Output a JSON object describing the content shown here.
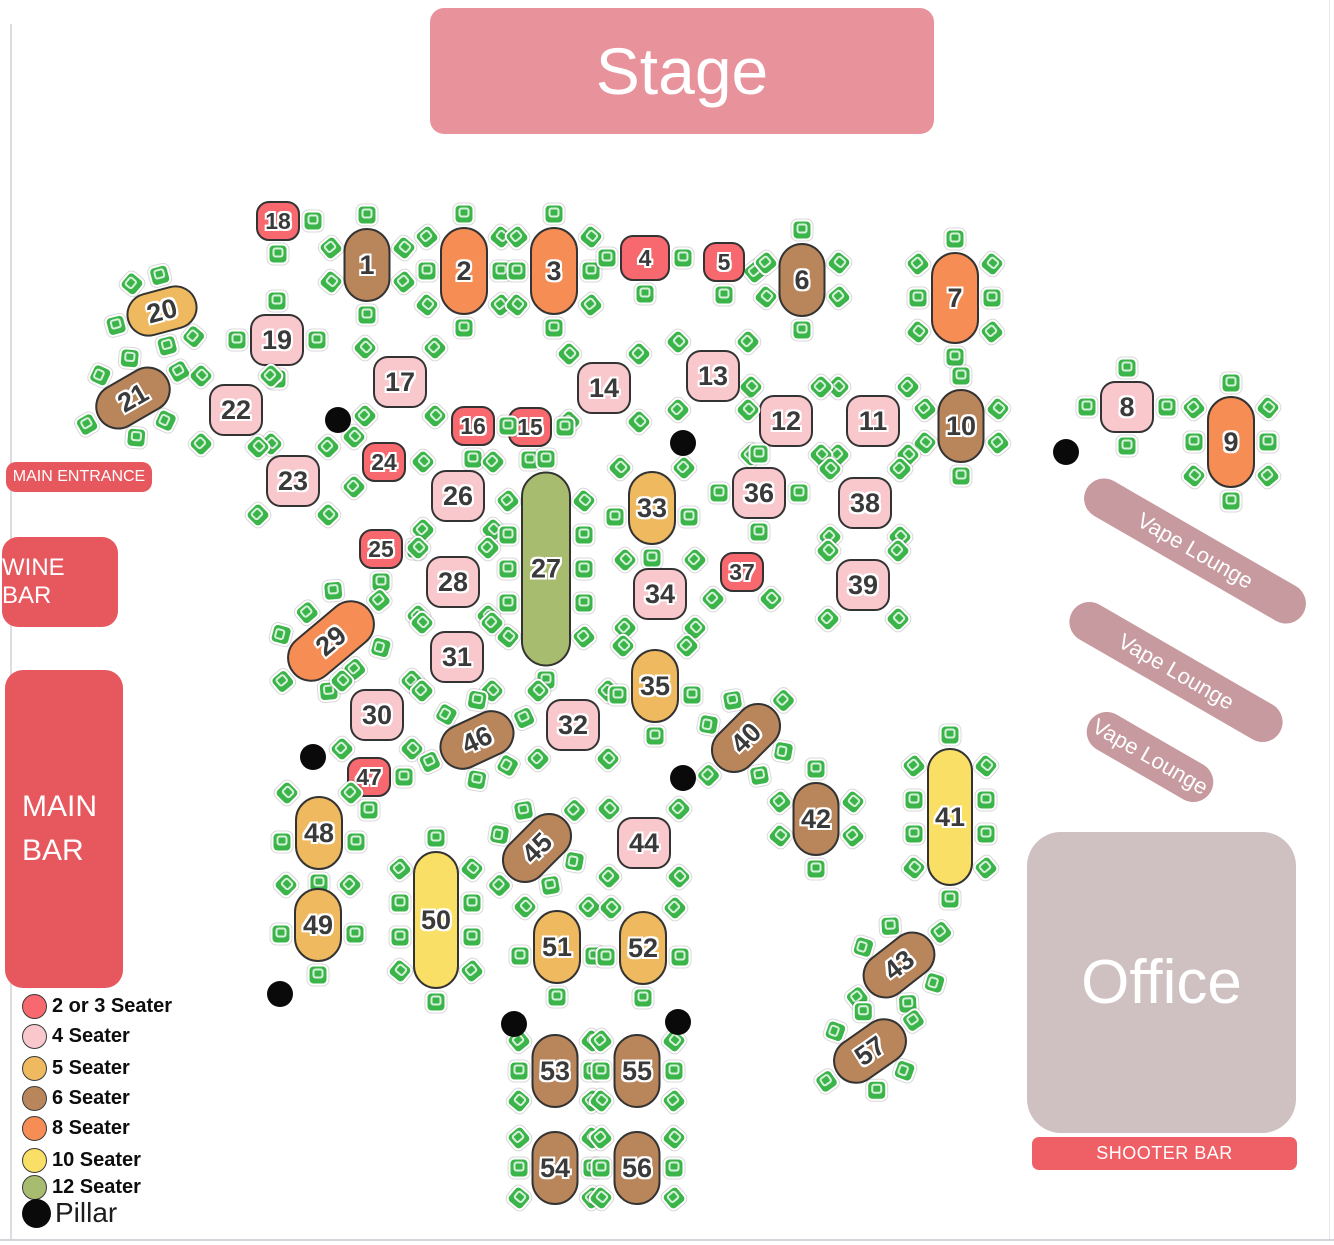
{
  "areas": {
    "stage": {
      "label": "Stage"
    },
    "main_entrance": {
      "label": "MAIN ENTRANCE"
    },
    "wine_bar": {
      "label": "WINE BAR"
    },
    "main_bar": {
      "line1": "MAIN",
      "line2": "BAR"
    },
    "office": {
      "label": "Office"
    },
    "shooter_bar": {
      "label": "SHOOTER BAR"
    },
    "vape_lounges": [
      {
        "label": "Vape Lounge",
        "cx": 1195,
        "cy": 551,
        "len": 250,
        "rot": 30
      },
      {
        "label": "Vape Lounge",
        "cx": 1176,
        "cy": 672,
        "len": 240,
        "rot": 30
      },
      {
        "label": "Vape Lounge",
        "cx": 1150,
        "cy": 757,
        "len": 140,
        "rot": 30
      }
    ]
  },
  "colors": {
    "stage": "#e8939c",
    "bar_red": "#e7575e",
    "shooter_red": "#ef6066",
    "vape_banner": "#c69a9e",
    "office": "#cfc0c2",
    "chair_green": "#3bb54a",
    "pillar_black": "#0a0a0a"
  },
  "table_colors": {
    "s2": "#f7696e",
    "s4": "#f9c8cd",
    "s5": "#eeb95f",
    "s6": "#b9855a",
    "s8": "#f68d54",
    "s10": "#f9df66",
    "s12": "#a8bc70"
  },
  "legend": {
    "items": [
      {
        "label": "2 or 3 Seater",
        "color": "#f7696e"
      },
      {
        "label": "4 Seater",
        "color": "#f9c8cd"
      },
      {
        "label": "5 Seater",
        "color": "#eeb95f"
      },
      {
        "label": "6 Seater",
        "color": "#b9855a"
      },
      {
        "label": "8 Seater",
        "color": "#f68d54"
      },
      {
        "label": "10 Seater",
        "color": "#f9df66"
      },
      {
        "label": "12 Seater",
        "color": "#a8bc70"
      }
    ],
    "pillar": {
      "label": "Pillar",
      "color": "#0a0a0a"
    }
  },
  "pillars": [
    [
      338,
      420
    ],
    [
      683,
      443
    ],
    [
      1066,
      452
    ],
    [
      313,
      757
    ],
    [
      683,
      778
    ],
    [
      280,
      994
    ],
    [
      514,
      1024
    ],
    [
      678,
      1022
    ]
  ],
  "tables": [
    {
      "n": "1",
      "x": 367,
      "y": 265,
      "kind": "s6",
      "pattern": "6v"
    },
    {
      "n": "2",
      "x": 464,
      "y": 271,
      "kind": "s8",
      "pattern": "8v"
    },
    {
      "n": "3",
      "x": 554,
      "y": 271,
      "kind": "s8",
      "pattern": "8v"
    },
    {
      "n": "4",
      "x": 645,
      "y": 258,
      "kind": "s2",
      "pattern": "3WES",
      "w": 50,
      "h": 46
    },
    {
      "n": "5",
      "x": 724,
      "y": 262,
      "kind": "s2",
      "pattern": "2SE_S",
      "w": 42,
      "h": 40
    },
    {
      "n": "6",
      "x": 802,
      "y": 280,
      "kind": "s6",
      "pattern": "6v"
    },
    {
      "n": "7",
      "x": 955,
      "y": 298,
      "kind": "s8",
      "pattern": "8v",
      "h": 92
    },
    {
      "n": "8",
      "x": 1127,
      "y": 407,
      "kind": "s4",
      "pattern": "4cross"
    },
    {
      "n": "9",
      "x": 1231,
      "y": 442,
      "kind": "s8",
      "pattern": "8v",
      "h": 92
    },
    {
      "n": "10",
      "x": 961,
      "y": 426,
      "kind": "s6",
      "pattern": "6v"
    },
    {
      "n": "11",
      "x": 873,
      "y": 421,
      "kind": "s4",
      "pattern": "4diag"
    },
    {
      "n": "12",
      "x": 786,
      "y": 421,
      "kind": "s4",
      "pattern": "4diag"
    },
    {
      "n": "13",
      "x": 713,
      "y": 376,
      "kind": "s4",
      "pattern": "4diag"
    },
    {
      "n": "14",
      "x": 604,
      "y": 388,
      "kind": "s4",
      "pattern": "4diag"
    },
    {
      "n": "15",
      "x": 530,
      "y": 427,
      "kind": "s2",
      "pattern": "2ES"
    },
    {
      "n": "16",
      "x": 473,
      "y": 426,
      "kind": "s2",
      "pattern": "2ES"
    },
    {
      "n": "17",
      "x": 400,
      "y": 382,
      "kind": "s4",
      "pattern": "4diag"
    },
    {
      "n": "18",
      "x": 278,
      "y": 221,
      "kind": "s2",
      "pattern": "2ES"
    },
    {
      "n": "19",
      "x": 277,
      "y": 340,
      "kind": "s4",
      "pattern": "4cross"
    },
    {
      "n": "20",
      "x": 162,
      "y": 311,
      "kind": "s5",
      "pattern": "5h",
      "w": 72,
      "h": 44,
      "rot": -15
    },
    {
      "n": "21",
      "x": 133,
      "y": 398,
      "kind": "s6",
      "pattern": "6h",
      "w": 80,
      "h": 46,
      "rot": -30
    },
    {
      "n": "22",
      "x": 236,
      "y": 410,
      "kind": "s4",
      "pattern": "4diag"
    },
    {
      "n": "23",
      "x": 293,
      "y": 481,
      "kind": "s4",
      "pattern": "4diag"
    },
    {
      "n": "24",
      "x": 384,
      "y": 462,
      "kind": "s2",
      "pattern": "2NW_SW"
    },
    {
      "n": "25",
      "x": 381,
      "y": 549,
      "kind": "s2",
      "pattern": "2ES"
    },
    {
      "n": "26",
      "x": 458,
      "y": 496,
      "kind": "s4",
      "pattern": "4diag"
    },
    {
      "n": "27",
      "x": 546,
      "y": 569,
      "kind": "s12",
      "pattern": "12v"
    },
    {
      "n": "28",
      "x": 453,
      "y": 582,
      "kind": "s4",
      "pattern": "4diag"
    },
    {
      "n": "29",
      "x": 331,
      "y": 641,
      "kind": "s8",
      "pattern": "8h",
      "w": 100,
      "h": 48,
      "rot": -40
    },
    {
      "n": "30",
      "x": 377,
      "y": 715,
      "kind": "s4",
      "pattern": "4diag"
    },
    {
      "n": "31",
      "x": 457,
      "y": 657,
      "kind": "s4",
      "pattern": "4diag"
    },
    {
      "n": "32",
      "x": 573,
      "y": 725,
      "kind": "s4",
      "pattern": "4diag"
    },
    {
      "n": "33",
      "x": 652,
      "y": 508,
      "kind": "s5",
      "pattern": "5"
    },
    {
      "n": "34",
      "x": 660,
      "y": 594,
      "kind": "s4",
      "pattern": "4diag"
    },
    {
      "n": "35",
      "x": 655,
      "y": 686,
      "kind": "s5",
      "pattern": "5"
    },
    {
      "n": "36",
      "x": 759,
      "y": 493,
      "kind": "s4",
      "pattern": "4cross"
    },
    {
      "n": "37",
      "x": 742,
      "y": 572,
      "kind": "s2",
      "pattern": "2SW_SE"
    },
    {
      "n": "38",
      "x": 865,
      "y": 503,
      "kind": "s4",
      "pattern": "4diag"
    },
    {
      "n": "39",
      "x": 863,
      "y": 585,
      "kind": "s4",
      "pattern": "4diag"
    },
    {
      "n": "40",
      "x": 746,
      "y": 738,
      "kind": "s6",
      "pattern": "6h",
      "w": 80,
      "h": 46,
      "rot": -45
    },
    {
      "n": "41",
      "x": 950,
      "y": 817,
      "kind": "s10",
      "pattern": "10v"
    },
    {
      "n": "42",
      "x": 816,
      "y": 819,
      "kind": "s6",
      "pattern": "6v"
    },
    {
      "n": "43",
      "x": 899,
      "y": 965,
      "kind": "s6",
      "pattern": "6h",
      "w": 80,
      "h": 46,
      "rot": -38
    },
    {
      "n": "44",
      "x": 644,
      "y": 843,
      "kind": "s4",
      "pattern": "4diag"
    },
    {
      "n": "45",
      "x": 537,
      "y": 848,
      "kind": "s6",
      "pattern": "6h",
      "w": 80,
      "h": 46,
      "rot": -45
    },
    {
      "n": "46",
      "x": 477,
      "y": 740,
      "kind": "s6",
      "pattern": "6h",
      "w": 78,
      "h": 46,
      "rot": -25
    },
    {
      "n": "47",
      "x": 369,
      "y": 777,
      "kind": "s2",
      "pattern": "2ES"
    },
    {
      "n": "48",
      "x": 319,
      "y": 833,
      "kind": "s5",
      "pattern": "5"
    },
    {
      "n": "49",
      "x": 318,
      "y": 925,
      "kind": "s5",
      "pattern": "5"
    },
    {
      "n": "50",
      "x": 436,
      "y": 920,
      "kind": "s10",
      "pattern": "10v"
    },
    {
      "n": "51",
      "x": 557,
      "y": 947,
      "kind": "s5",
      "pattern": "5"
    },
    {
      "n": "52",
      "x": 643,
      "y": 948,
      "kind": "s5",
      "pattern": "5"
    },
    {
      "n": "53",
      "x": 555,
      "y": 1071,
      "kind": "s6",
      "pattern": "6sides"
    },
    {
      "n": "54",
      "x": 555,
      "y": 1168,
      "kind": "s6",
      "pattern": "6sides"
    },
    {
      "n": "55",
      "x": 637,
      "y": 1071,
      "kind": "s6",
      "pattern": "6sides"
    },
    {
      "n": "56",
      "x": 637,
      "y": 1168,
      "kind": "s6",
      "pattern": "6sides"
    },
    {
      "n": "57",
      "x": 870,
      "y": 1051,
      "kind": "s6",
      "pattern": "6h",
      "w": 80,
      "h": 46,
      "rot": -35
    }
  ]
}
